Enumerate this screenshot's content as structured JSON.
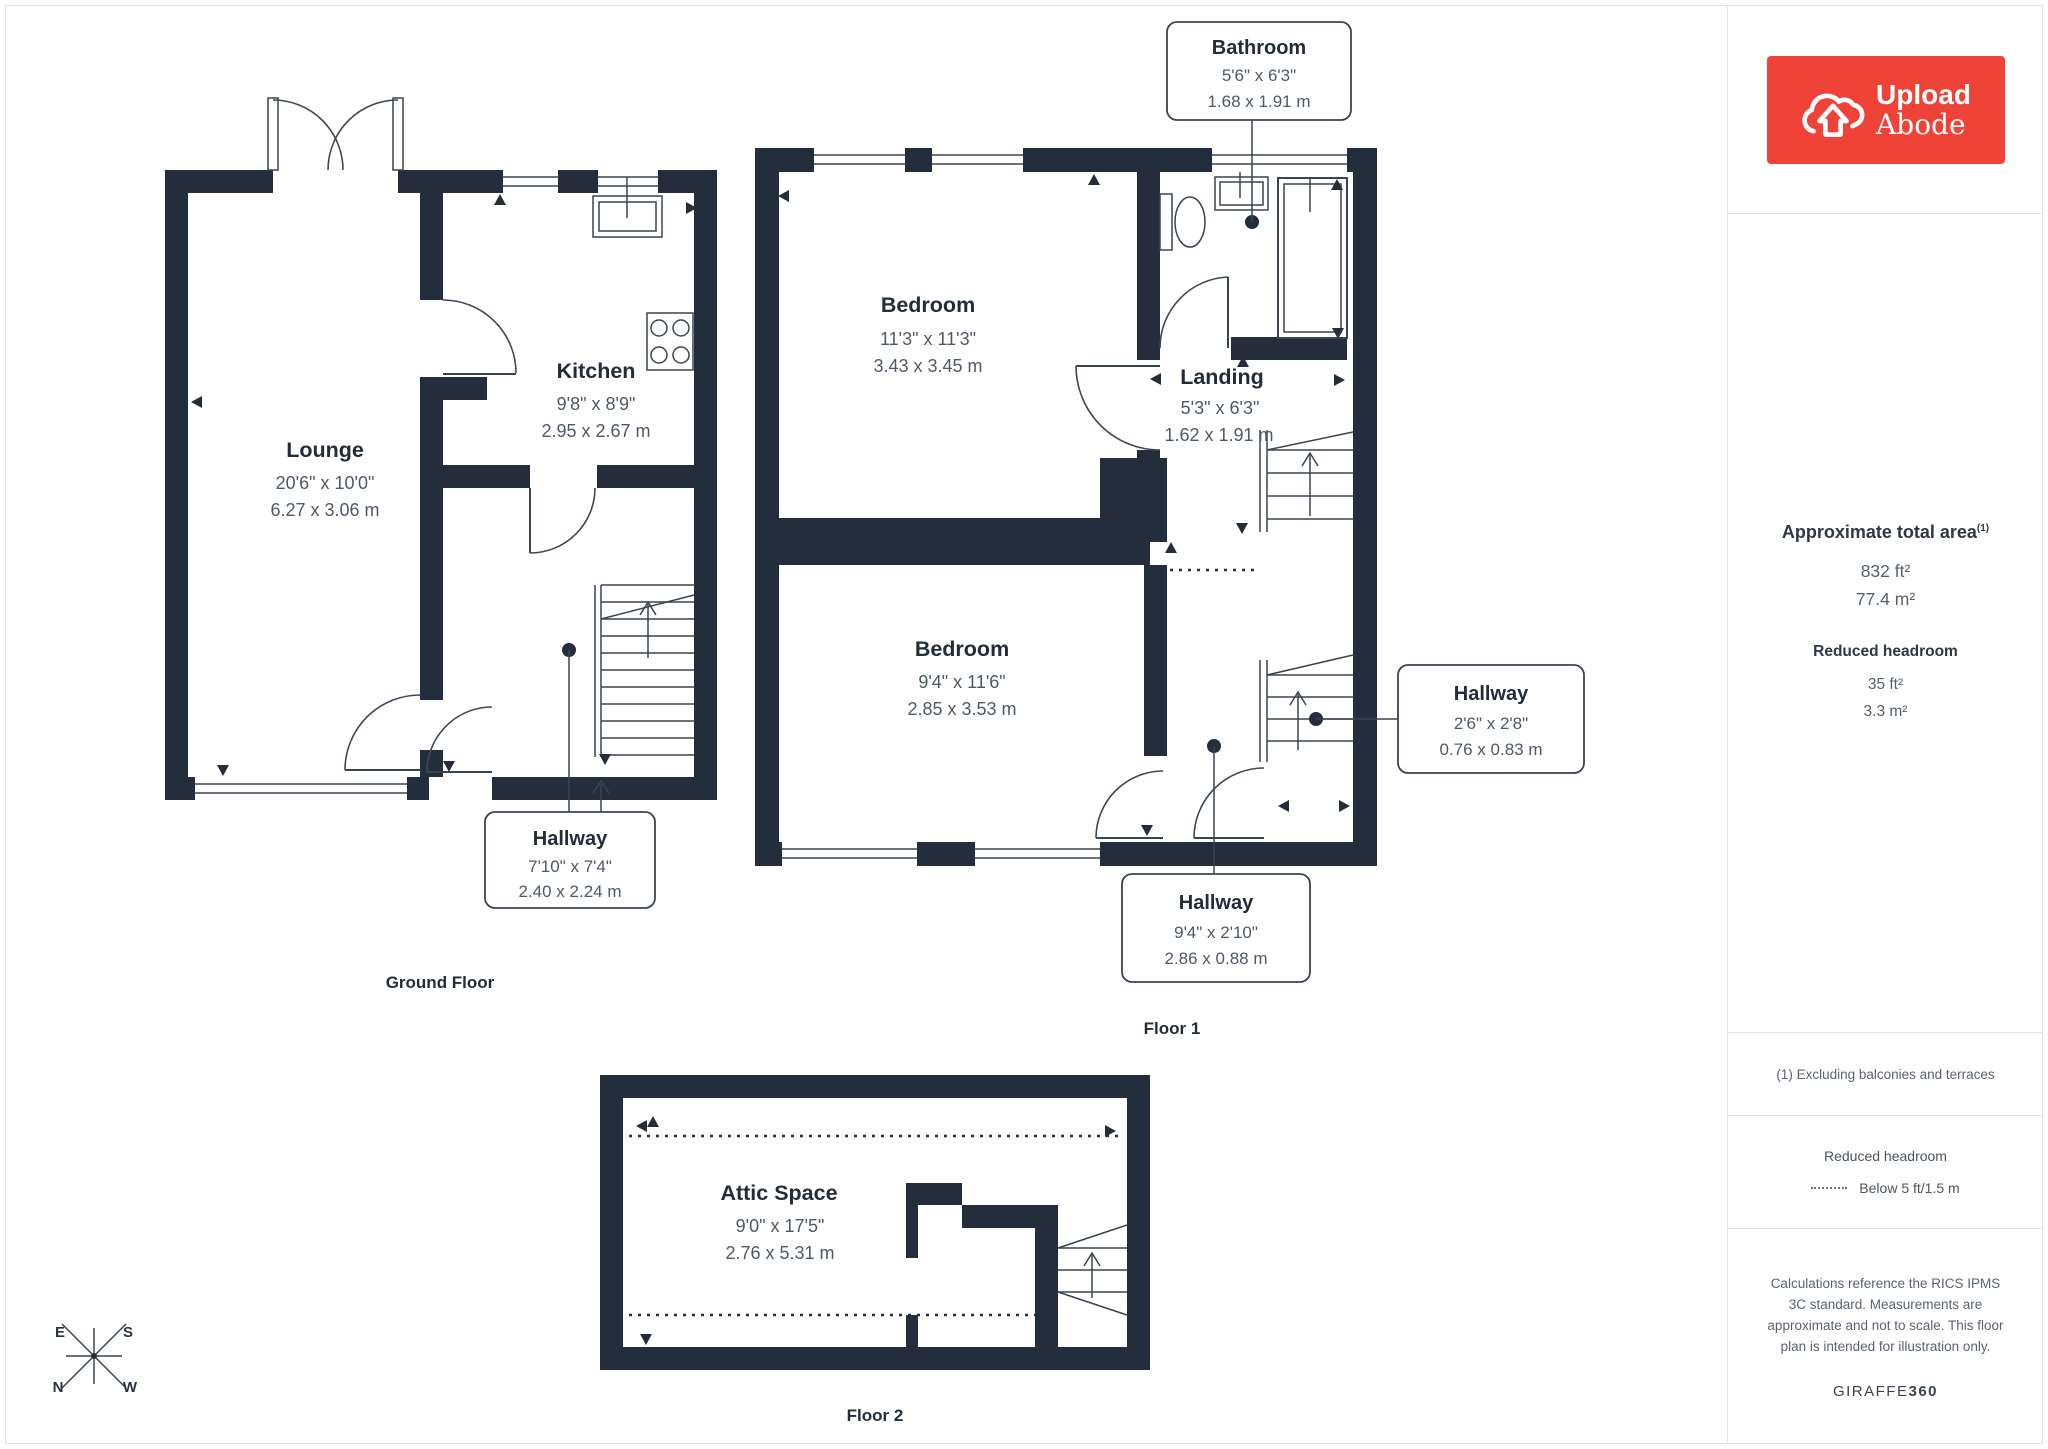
{
  "branding": {
    "logo_line1": "Upload",
    "logo_line2": "Abode"
  },
  "sidebar": {
    "total_area": {
      "title": "Approximate total area",
      "superscript": "(1)",
      "sqft": "832 ft²",
      "sqm": "77.4 m²"
    },
    "reduced_headroom": {
      "title": "Reduced headroom",
      "sqft": "35 ft²",
      "sqm": "3.3 m²"
    },
    "footnote": "(1) Excluding balconies and terraces",
    "legend": {
      "title": "Reduced headroom",
      "label": "Below 5 ft/1.5 m"
    },
    "disclaimer": "Calculations reference the RICS IPMS 3C standard. Measurements are approximate and not to scale. This floor plan is intended for illustration only.",
    "provider": {
      "name": "GIRAFFE",
      "suffix": "360"
    }
  },
  "floors": [
    {
      "caption": "Ground Floor",
      "rooms": [
        {
          "name": "Lounge",
          "imperial": "20'6\" x 10'0\"",
          "metric": "6.27 x 3.06 m"
        },
        {
          "name": "Kitchen",
          "imperial": "9'8\" x 8'9\"",
          "metric": "2.95 x 2.67 m"
        },
        {
          "name": "Hallway",
          "imperial": "7'10\" x 7'4\"",
          "metric": "2.40 x 2.24 m"
        }
      ]
    },
    {
      "caption": "Floor 1",
      "rooms": [
        {
          "name": "Bathroom",
          "imperial": "5'6\" x 6'3\"",
          "metric": "1.68 x 1.91 m"
        },
        {
          "name": "Bedroom",
          "imperial": "11'3\" x 11'3\"",
          "metric": "3.43 x 3.45 m"
        },
        {
          "name": "Landing",
          "imperial": "5'3\" x 6'3\"",
          "metric": "1.62 x 1.91 m"
        },
        {
          "name": "Bedroom",
          "imperial": "9'4\" x 11'6\"",
          "metric": "2.85 x 3.53 m"
        },
        {
          "name": "Hallway",
          "imperial": "2'6\" x 2'8\"",
          "metric": "0.76 x 0.83 m"
        },
        {
          "name": "Hallway",
          "imperial": "9'4\" x 2'10\"",
          "metric": "2.86 x 0.88 m"
        }
      ]
    },
    {
      "caption": "Floor 2",
      "rooms": [
        {
          "name": "Attic Space",
          "imperial": "9'0\" x 17'5\"",
          "metric": "2.76 x 5.31 m"
        }
      ]
    }
  ],
  "compass": {
    "n": "N",
    "e": "E",
    "s": "S",
    "w": "W"
  }
}
